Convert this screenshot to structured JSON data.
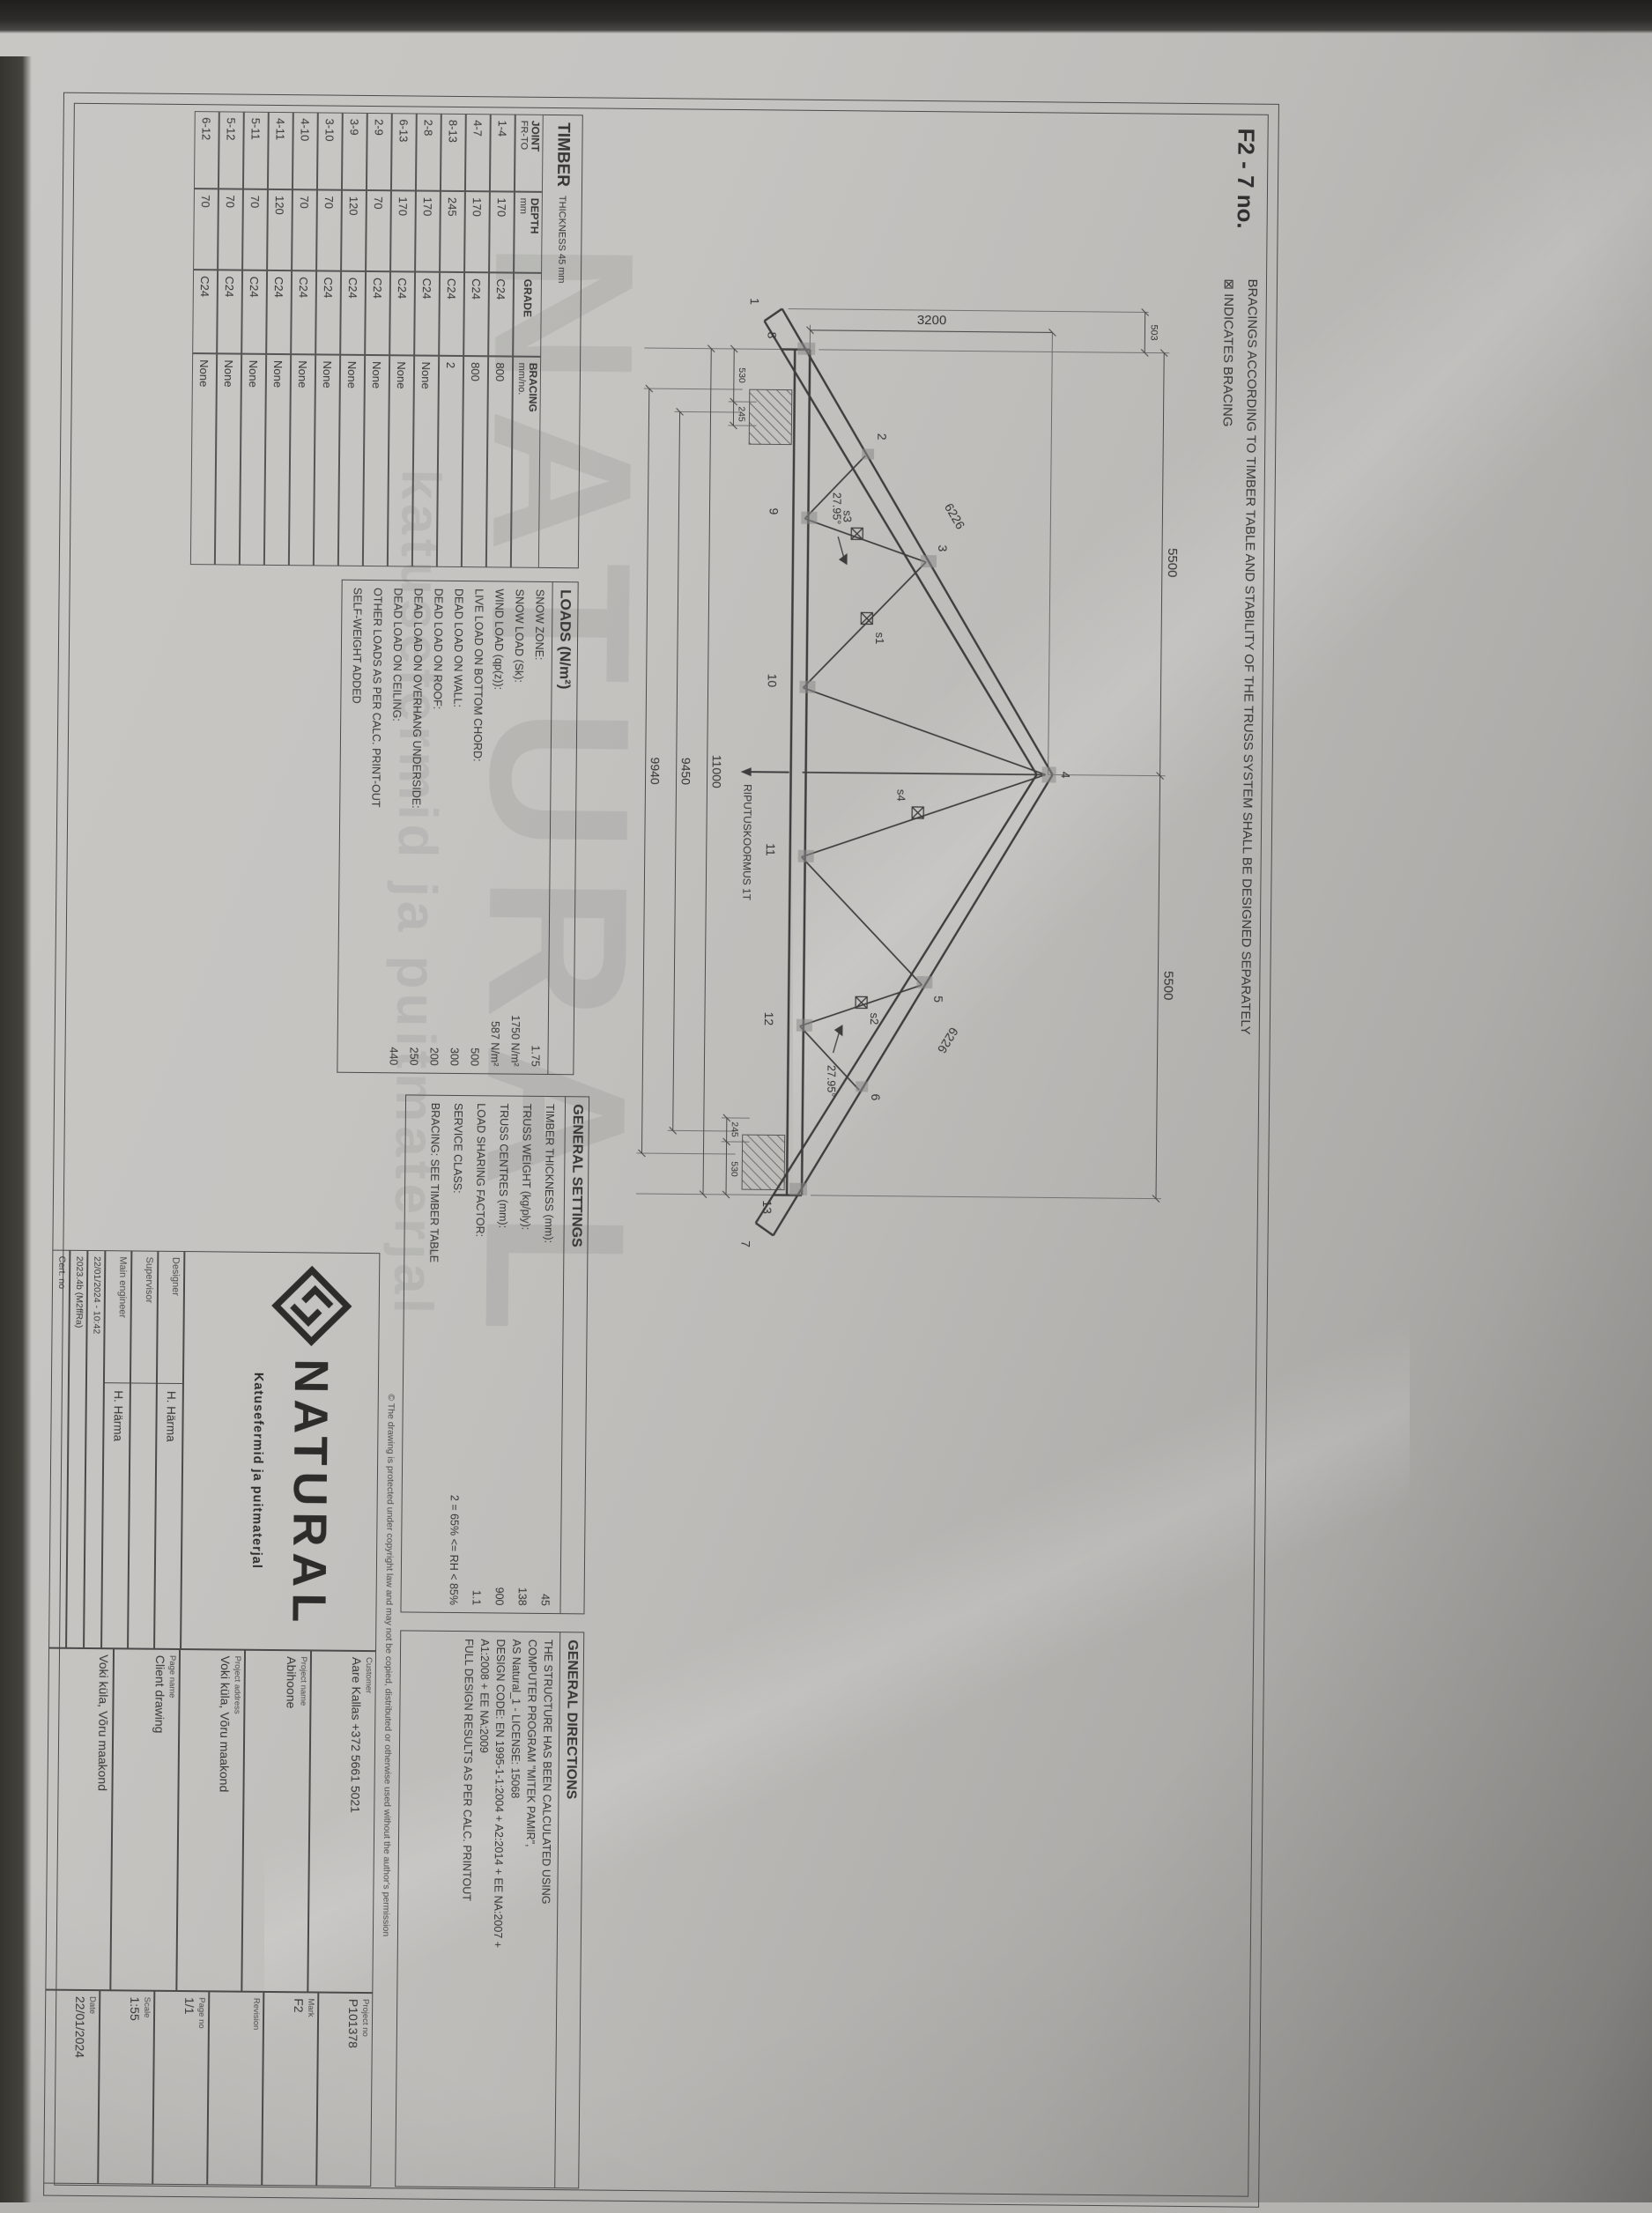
{
  "page": {
    "mark": "F2 - 7 no."
  },
  "notes": {
    "bracing_note": "BRACINGS ACCORDING TO TIMBER TABLE AND STABILITY OF THE TRUSS SYSTEM SHALL BE DESIGNED SEPARATELY",
    "indicates_bracing": "⊠ INDICATES BRACING"
  },
  "watermark": {
    "brand": "NATURAL",
    "tagline": "katusefermid ja puitmaterjal"
  },
  "timber_table": {
    "title": "TIMBER",
    "title_suffix": "THICKNESS 45 mm",
    "headers": {
      "joint_l1": "JOINT",
      "joint_l2": "FR-TO",
      "depth_l1": "DEPTH",
      "depth_l2": "mm",
      "grade": "GRADE",
      "bracing_l1": "BRACING",
      "bracing_l2": "mm/no."
    },
    "rows": [
      {
        "joint": "1-4",
        "depth": "170",
        "grade": "C24",
        "bracing": "800"
      },
      {
        "joint": "4-7",
        "depth": "170",
        "grade": "C24",
        "bracing": "800"
      },
      {
        "joint": "8-13",
        "depth": "245",
        "grade": "C24",
        "bracing": "2"
      },
      {
        "joint": "2-8",
        "depth": "170",
        "grade": "C24",
        "bracing": "None"
      },
      {
        "joint": "6-13",
        "depth": "170",
        "grade": "C24",
        "bracing": "None"
      },
      {
        "joint": "2-9",
        "depth": "70",
        "grade": "C24",
        "bracing": "None"
      },
      {
        "joint": "3-9",
        "depth": "120",
        "grade": "C24",
        "bracing": "None"
      },
      {
        "joint": "3-10",
        "depth": "70",
        "grade": "C24",
        "bracing": "None"
      },
      {
        "joint": "4-10",
        "depth": "70",
        "grade": "C24",
        "bracing": "None"
      },
      {
        "joint": "4-11",
        "depth": "120",
        "grade": "C24",
        "bracing": "None"
      },
      {
        "joint": "5-11",
        "depth": "70",
        "grade": "C24",
        "bracing": "None"
      },
      {
        "joint": "5-12",
        "depth": "70",
        "grade": "C24",
        "bracing": "None"
      },
      {
        "joint": "6-12",
        "depth": "70",
        "grade": "C24",
        "bracing": "None"
      }
    ]
  },
  "loads_table": {
    "title": "LOADS (N/m²)",
    "rows": [
      {
        "label": "SNOW ZONE:",
        "value": "1.75"
      },
      {
        "label": "SNOW LOAD (Sk):",
        "value": "1750 N/m²"
      },
      {
        "label": "WIND LOAD (qp(z)):",
        "value": "587 N/m²"
      },
      {
        "label": "LIVE LOAD ON BOTTOM CHORD:",
        "value": "500"
      },
      {
        "label": "DEAD LOAD ON WALL:",
        "value": "300"
      },
      {
        "label": "DEAD LOAD ON ROOF:",
        "value": "200"
      },
      {
        "label": "DEAD LOAD ON OVERHANG UNDERSIDE:",
        "value": "250"
      },
      {
        "label": "DEAD LOAD ON CEILING:",
        "value": "440"
      },
      {
        "label": "OTHER LOADS AS PER CALC. PRINT-OUT",
        "value": ""
      },
      {
        "label": "SELF-WEIGHT ADDED",
        "value": ""
      }
    ]
  },
  "general_settings": {
    "title": "GENERAL SETTINGS",
    "rows": [
      {
        "label": "TIMBER THICKNESS (mm):",
        "value": "45"
      },
      {
        "label": "TRUSS WEIGHT (kg/ply):",
        "value": "138"
      },
      {
        "label": "TRUSS CENTRES (mm):",
        "value": "900"
      },
      {
        "label": "LOAD SHARING FACTOR:",
        "value": "1.1"
      },
      {
        "label": "SERVICE CLASS:",
        "value": "2 = 65% <= RH < 85%"
      },
      {
        "label": "BRACING: SEE TIMBER TABLE",
        "value": ""
      }
    ]
  },
  "general_directions": {
    "title": "GENERAL DIRECTIONS",
    "lines": [
      "THE STRUCTURE HAS BEEN CALCULATED USING",
      "COMPUTER PROGRAM \"MITEK PAMIR\",",
      "AS Natural_1 - LICENSE: 15068",
      "DESIGN CODE: EN 1995-1-1:2004 + A2:2014 + EE NA:2007 +",
      "A1:2008 + EE NA:2009",
      "FULL DESIGN RESULTS AS PER CALC. PRINTOUT"
    ]
  },
  "copyright": "© The drawing is protected under copyright law and may not be copied, distributed or otherwise used without the author's permission",
  "truss": {
    "dims": {
      "half_span_left": "5500",
      "half_span_right": "5500",
      "height": "3200",
      "overhang": "503",
      "chord_left": "6226",
      "chord_right": "6226",
      "angle_left": "27.95°",
      "angle_right": "27.95°",
      "heel_left_a": "530",
      "heel_left_b": "245",
      "heel_right_a": "245",
      "heel_right_b": "530",
      "bottom_1": "11000",
      "bottom_2": "9450",
      "bottom_3": "9940"
    },
    "hanging_load": "RIPUTUSKOORMUS 1T",
    "joints": {
      "j1": "1",
      "j2": "2",
      "j3": "3",
      "j4": "4",
      "j5": "5",
      "j6": "6",
      "j7": "7",
      "j8": "8",
      "j9": "9",
      "j10": "10",
      "j11": "11",
      "j12": "12",
      "j13": "13",
      "s1": "s1",
      "s2": "s2",
      "s3": "s3",
      "s4": "s4"
    }
  },
  "title_block": {
    "brand": "NATURAL",
    "brand_tagline": "Katusefermid ja puitmaterjal",
    "fields_mid": [
      {
        "label": "Customer",
        "value": "Aare Kallas +372 5661 5021"
      },
      {
        "label": "Project name",
        "value": "Abihoone"
      },
      {
        "label": "Project address",
        "value": "Voki küla, Võru maakond"
      },
      {
        "label": "Page name",
        "value": "Client drawing"
      },
      {
        "label": "",
        "value": "Voki küla, Võru maakond"
      }
    ],
    "fields_right": [
      {
        "label": "Project no",
        "value": "P101378"
      },
      {
        "label": "Mark",
        "value": "F2"
      },
      {
        "label": "Revision",
        "value": ""
      },
      {
        "label": "Page no",
        "value": "1/1"
      },
      {
        "label": "Scale",
        "value": "1:55"
      },
      {
        "label": "Date",
        "value": "22/01/2024"
      }
    ],
    "staff": [
      {
        "label": "Designer",
        "value": "H. Härma"
      },
      {
        "label": "Supervisor",
        "value": ""
      },
      {
        "label": "Main engineer",
        "value": "H. Härma"
      }
    ],
    "footer": [
      "22/01/2024 - 10:42",
      "2023.4b (M2ffRa)",
      "Cert. no"
    ]
  }
}
